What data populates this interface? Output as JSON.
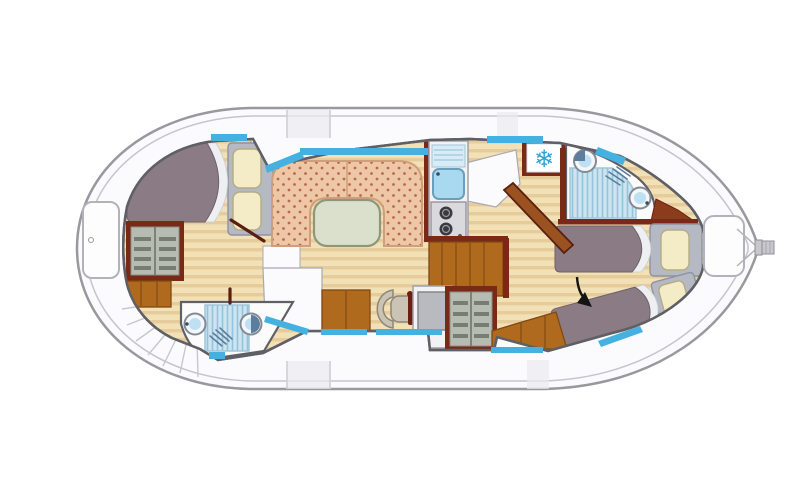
{
  "diagram": {
    "kind": "boat-deck-floor-plan",
    "orientation": "bow-left-stern-right"
  },
  "areas": [
    {
      "id": "bow-deck"
    },
    {
      "id": "bow-cabin"
    },
    {
      "id": "bow-bathroom"
    },
    {
      "id": "stairs"
    },
    {
      "id": "salon-dinette"
    },
    {
      "id": "galley"
    },
    {
      "id": "helm-station"
    },
    {
      "id": "corridor"
    },
    {
      "id": "aft-bathroom"
    },
    {
      "id": "aft-cabin"
    },
    {
      "id": "stern-deck"
    }
  ],
  "icons": {
    "snowflake_glyph": "❄",
    "names": [
      "snowflake-icon",
      "shower-head-icon",
      "toilet-icon",
      "sink-icon",
      "stove-burners-icon",
      "steering-wheel-icon",
      "conversion-arrow-icon"
    ]
  },
  "colors": {
    "hull_fill": "#fbfbfd",
    "hull_line": "#98989e",
    "hull_line2": "#c5c5cb",
    "deck_shade": "#ebebef",
    "wall": "#5f5f66",
    "wall_red": "#7b2917",
    "wood_base": "#f2e0b6",
    "wood_stripe": "#e6cc9b",
    "window": "#45b1e0",
    "blanket": "#8b7b85",
    "blanket_dark": "#6f6069",
    "sheet": "#edeff1",
    "pillow": "#f3ecc6",
    "pillow_line": "#b5ab84",
    "headboard": "#b5b9c3",
    "sofa": "#eec8a6",
    "sofa_dot": "#b96a4e",
    "sofa_line": "#cf9f7c",
    "table": "#dbe0cc",
    "table_line": "#8f977b",
    "orange": "#b06a1e",
    "orange_dark": "#7e4812",
    "wardrobe_in": "#b7bcb2",
    "shelf": "#767d73",
    "bath": "#fbfbfc",
    "shower_base": "#cde5f1",
    "shower_line": "#96c2da",
    "fixture_fill": "#f4f7fa",
    "fixture_line": "#848a94",
    "fixture_blue": "#bfe0f2",
    "toilet_dark": "#5c7d9c",
    "stove": "#d9d9de",
    "burner": "#3a3a41",
    "console": "#b9b9c0",
    "console_line": "#85858c",
    "chair": "#cbc4b4",
    "chair_line": "#8d8779",
    "desk": "#f2f2f5",
    "snowflake": "#2fa3d6",
    "arrow": "#141414",
    "stairs_line": "#c7c7cd"
  }
}
